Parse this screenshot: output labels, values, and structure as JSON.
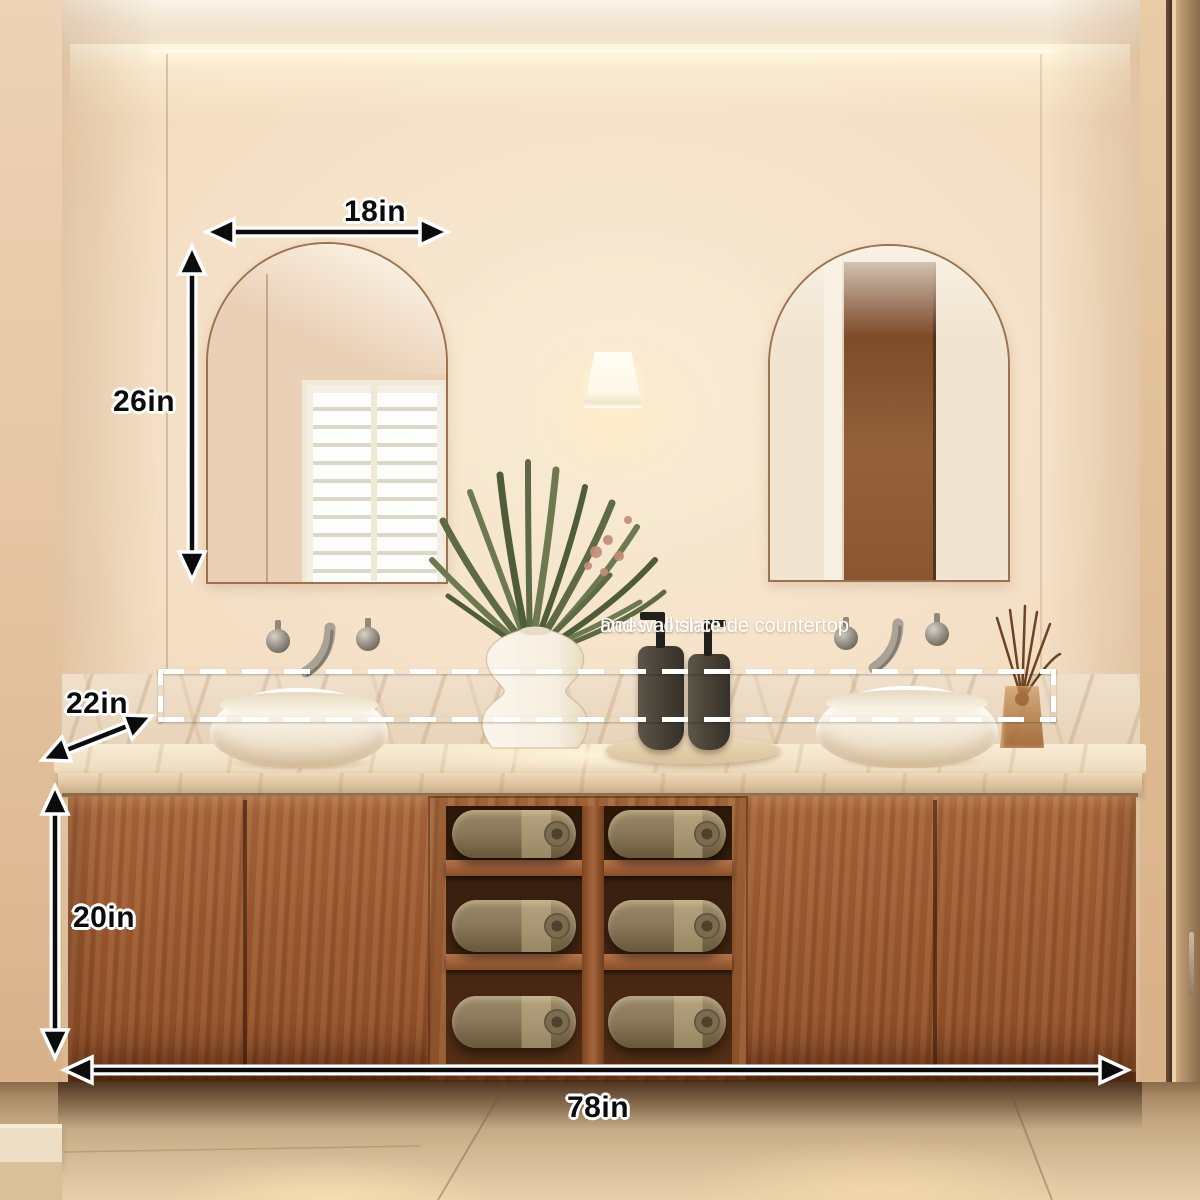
{
  "annotations": {
    "mirror_width_label": "18in",
    "mirror_height_label": "26in",
    "counter_depth_label": "22in",
    "cabinet_height_label": "20in",
    "vanity_width_label": "78in",
    "disclaimer_line1": "Does not include countertop",
    "disclaimer_line2": "and wall slate"
  },
  "colors": {
    "annotation_text": "#0c0c0c",
    "annotation_outline": "#ffffff",
    "dashed_box": "#ffffff",
    "disclaimer_text": "#ffffff",
    "wall": "#f3ddc4",
    "wood_cabinet": "#9a5830",
    "marble": "#eddcc3",
    "towel": "#8d7c60",
    "floor": "#c9ae8c"
  }
}
